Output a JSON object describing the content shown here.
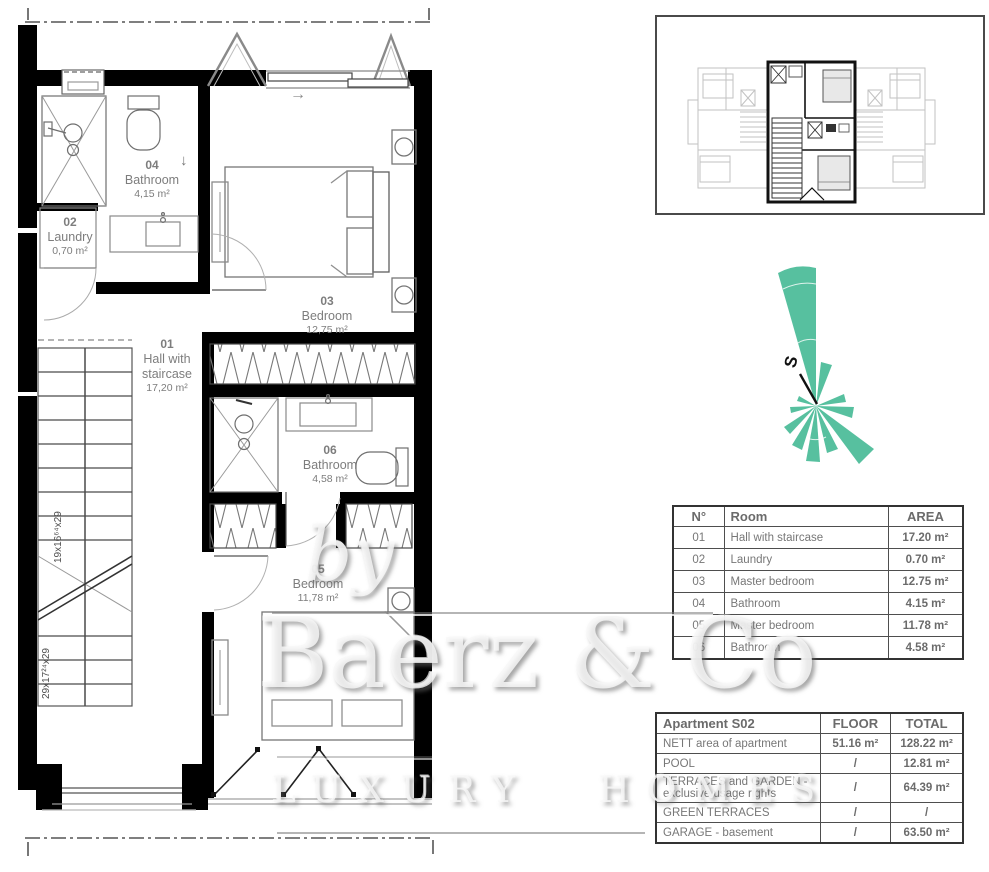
{
  "plan": {
    "rooms": {
      "r01": {
        "number": "01",
        "name": "Hall with staircase",
        "area": "17,20 m²"
      },
      "r02": {
        "number": "02",
        "name": "Laundry",
        "area": "0,70 m²"
      },
      "r03": {
        "number": "03",
        "name": "Bedroom",
        "area": "12,75 m²"
      },
      "r04": {
        "number": "04",
        "name": "Bathroom",
        "area": "4,15 m²"
      },
      "r05": {
        "number": "05",
        "name": "Bedroom",
        "area": "11,78 m²"
      },
      "r06": {
        "number": "06",
        "name": "Bathroom",
        "area": "4,58 m²"
      }
    },
    "stair_marks": {
      "upper": "19x16⁶⁴x29",
      "lower": "29x17²⁴x29"
    },
    "arrows": {
      "window": "→",
      "bathroom": "↓"
    }
  },
  "compass": {
    "south": "S",
    "rose_color": "#57c09f"
  },
  "watermark": {
    "by": "by",
    "brand": "Baerz & Co",
    "tagline": "LUXURY HOMES"
  },
  "room_table": {
    "headers": {
      "n": "N°",
      "room": "Room",
      "area": "AREA"
    },
    "rows": [
      {
        "n": "01",
        "room": "Hall with staircase",
        "area": "17.20 m²"
      },
      {
        "n": "02",
        "room": "Laundry",
        "area": "0.70 m²"
      },
      {
        "n": "03",
        "room": "Master bedroom",
        "area": "12.75 m²"
      },
      {
        "n": "04",
        "room": "Bathroom",
        "area": "4.15 m²"
      },
      {
        "n": "05",
        "room": "Master bedroom",
        "area": "11.78 m²"
      },
      {
        "n": "06",
        "room": "Bathroom",
        "area": "4.58 m²"
      }
    ]
  },
  "apartment_table": {
    "title": "Apartment S02",
    "headers": {
      "floor": "FLOOR",
      "total": "TOTAL"
    },
    "rows": [
      {
        "label": "NETT area of apartment",
        "floor": "51.16 m²",
        "total": "128.22 m²"
      },
      {
        "label": "POOL",
        "floor": "/",
        "total": "12.81 m²"
      },
      {
        "label": "TERRACES and GARDEN - exclusive usage rights",
        "floor": "/",
        "total": "64.39 m²"
      },
      {
        "label": "GREEN TERRACES",
        "floor": "/",
        "total": "/"
      },
      {
        "label": "GARAGE - basement",
        "floor": "/",
        "total": "63.50 m²"
      }
    ]
  }
}
